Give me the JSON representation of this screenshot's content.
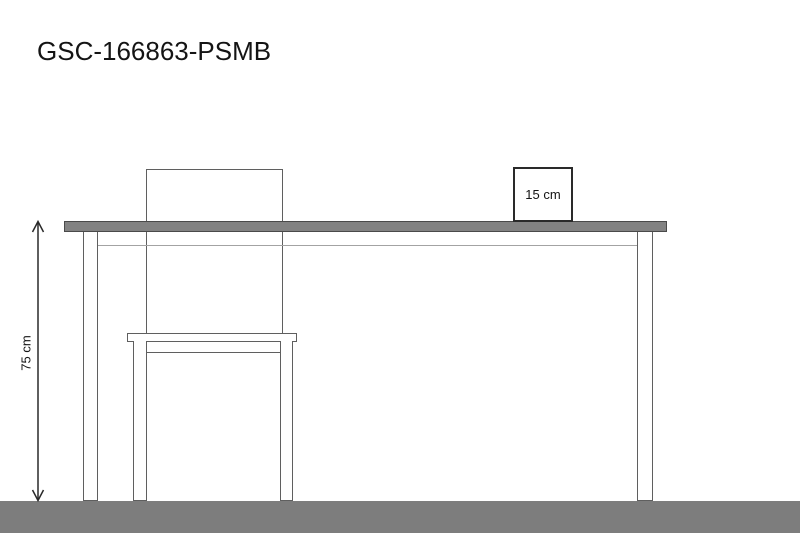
{
  "title": "GSC-166863-PSMB",
  "dimension": {
    "label": "75 cm"
  },
  "box": {
    "label": "15 cm"
  },
  "colors": {
    "background": "#ffffff",
    "floor": "#7d7d7d",
    "tabletop-fill": "#828282",
    "tabletop-border": "#4a4a4a",
    "line-dark": "#2a2a2a",
    "line-medium": "#5f5f5f",
    "line-light": "#a3a3a3",
    "text": "#141414"
  }
}
